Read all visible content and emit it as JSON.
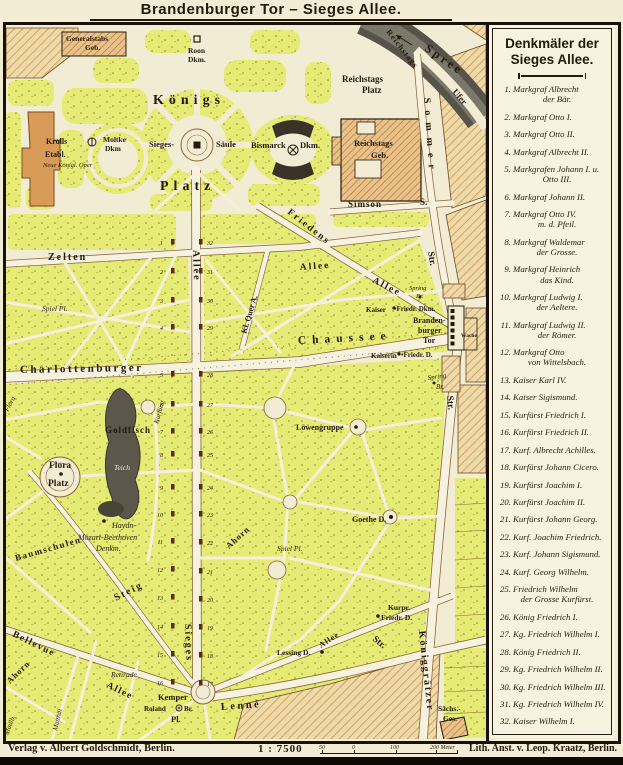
{
  "palette": {
    "paper": "#f3ecd4",
    "park": "#e5eb74",
    "built_hatch": "#eedaa8",
    "building": "#e9c28b",
    "building_solid": "#d89c58",
    "water": "#57534a",
    "road_edge": "#8a6636",
    "ink": "#241a0c",
    "monument": "#5d2a12"
  },
  "title": "Brandenburger Tor – Sieges Allee.",
  "legend": {
    "title_line1": "Denkmäler der",
    "title_line2": "Sieges Allee.",
    "entries": [
      {
        "n": "1.",
        "text": "Markgraf Albrecht",
        "line2": "der Bär."
      },
      {
        "n": "2.",
        "text": "Markgraf Otto I."
      },
      {
        "n": "3.",
        "text": "Markgraf Otto II."
      },
      {
        "n": "4.",
        "text": "Markgraf Albrecht II."
      },
      {
        "n": "5.",
        "text": "Markgrafen Johann I. u.",
        "line2": "Otto III."
      },
      {
        "n": "6.",
        "text": "Markgraf Johann II."
      },
      {
        "n": "7.",
        "text": "Markgraf Otto IV.",
        "line2": "m. d. Pfeil."
      },
      {
        "n": "8.",
        "text": "Markgraf Waldemar",
        "line2": "der Grosse."
      },
      {
        "n": "9.",
        "text": "Markgraf Heinrich",
        "line2": "das Kind."
      },
      {
        "n": "10.",
        "text": "Markgraf Ludwig I.",
        "line2": "der Aeltere."
      },
      {
        "n": "11.",
        "text": "Markgraf Ludwig II.",
        "line2": "der Römer."
      },
      {
        "n": "12.",
        "text": "Markgraf Otto",
        "line2": "von Wittelsbach."
      },
      {
        "n": "13.",
        "text": "Kaiser Karl IV."
      },
      {
        "n": "14.",
        "text": "Kaiser Sigismund."
      },
      {
        "n": "15.",
        "text": "Kurfürst Friedrich I."
      },
      {
        "n": "16.",
        "text": "Kurfürst Friedrich II."
      },
      {
        "n": "17.",
        "text": "Kurf. Albrecht Achilles."
      },
      {
        "n": "18.",
        "text": "Kurfürst Johann Cicero."
      },
      {
        "n": "19.",
        "text": "Kurfürst Joachim I."
      },
      {
        "n": "20.",
        "text": "Kurfürst Joachim II."
      },
      {
        "n": "21.",
        "text": "Kurfürst Johann Georg."
      },
      {
        "n": "22.",
        "text": "Kurf. Joachim Friedrich."
      },
      {
        "n": "23.",
        "text": "Kurf. Johann Sigismund."
      },
      {
        "n": "24.",
        "text": "Kurf. Georg Wilhelm."
      },
      {
        "n": "25.",
        "text": "Friedrich Wilhelm",
        "line2": "der Grosse Kurfürst."
      },
      {
        "n": "26.",
        "text": "König Friedrich I."
      },
      {
        "n": "27.",
        "text": "Kg. Friedrich Wilhelm I."
      },
      {
        "n": "28.",
        "text": "König Friedrich II."
      },
      {
        "n": "29.",
        "text": "Kg. Friedrich Wilhelm II."
      },
      {
        "n": "30.",
        "text": "Kg. Friedrich Wilhelm III."
      },
      {
        "n": "31.",
        "text": "Kg. Friedrich Wilhelm IV."
      },
      {
        "n": "32.",
        "text": "Kaiser Wilhelm I."
      }
    ]
  },
  "map": {
    "labels": [
      {
        "t": "Generalstabs",
        "x": 66,
        "y": 41,
        "s": 7.5
      },
      {
        "t": "Geb.",
        "x": 85,
        "y": 50,
        "s": 7.5
      },
      {
        "t": "Roon",
        "x": 188,
        "y": 53,
        "s": 7.5
      },
      {
        "t": "Dkm.",
        "x": 188,
        "y": 62,
        "s": 7.5
      },
      {
        "t": "Reichstags",
        "x": 386,
        "y": 32,
        "s": 8,
        "r": 52,
        "ls": 1
      },
      {
        "t": "Spree",
        "x": 424,
        "y": 50,
        "s": 12,
        "r": 35,
        "ls": 3
      },
      {
        "t": "Ufer",
        "x": 452,
        "y": 92,
        "s": 9,
        "r": 50
      },
      {
        "t": "Reichstags",
        "x": 342,
        "y": 82,
        "s": 9
      },
      {
        "t": "Platz",
        "x": 362,
        "y": 93,
        "s": 9
      },
      {
        "t": "Königs",
        "x": 153,
        "y": 104,
        "s": 14,
        "ls": 5
      },
      {
        "t": "Platz",
        "x": 160,
        "y": 190,
        "s": 14,
        "ls": 5
      },
      {
        "t": "Krolls",
        "x": 46,
        "y": 144,
        "s": 8
      },
      {
        "t": "Etabl.",
        "x": 45,
        "y": 157,
        "s": 8
      },
      {
        "t": "Neue Königl. Oper",
        "x": 43,
        "y": 167,
        "s": 6.5,
        "c": "i"
      },
      {
        "t": "Moltke",
        "x": 103,
        "y": 142,
        "s": 7.5
      },
      {
        "t": "Dkm",
        "x": 105,
        "y": 151,
        "s": 7.5
      },
      {
        "t": "Sieges-",
        "x": 149,
        "y": 147,
        "s": 8.5
      },
      {
        "t": "Säule",
        "x": 216,
        "y": 147,
        "s": 8.5
      },
      {
        "t": "Bismarck",
        "x": 251,
        "y": 148,
        "s": 8.5
      },
      {
        "t": "Dkm.",
        "x": 300,
        "y": 148,
        "s": 8.5
      },
      {
        "t": "Reichstags",
        "x": 354,
        "y": 146,
        "s": 8.5
      },
      {
        "t": "Geb.",
        "x": 371,
        "y": 158,
        "s": 8.5
      },
      {
        "t": "Sommer",
        "x": 424,
        "y": 98,
        "s": 10,
        "r": 86,
        "ls": 7
      },
      {
        "t": "Str.",
        "x": 428,
        "y": 252,
        "s": 9.5,
        "r": 80
      },
      {
        "t": "Simson",
        "x": 348,
        "y": 207,
        "s": 9,
        "ls": 1
      },
      {
        "t": "S.",
        "x": 420,
        "y": 205,
        "s": 9
      },
      {
        "t": "Friedens",
        "x": 287,
        "y": 213,
        "s": 9.5,
        "r": 38,
        "ls": 2
      },
      {
        "t": "Allee",
        "x": 300,
        "y": 270,
        "s": 9.5,
        "r": -4,
        "ls": 2
      },
      {
        "t": "Allee",
        "x": 372,
        "y": 282,
        "s": 9.5,
        "r": 27,
        "ls": 2
      },
      {
        "t": "Zelten",
        "x": 48,
        "y": 260,
        "s": 10,
        "ls": 2
      },
      {
        "t": "Allee",
        "x": 193,
        "y": 250,
        "s": 10,
        "r": 88,
        "ls": 2
      },
      {
        "t": "Kl. Quer A.",
        "x": 246,
        "y": 334,
        "s": 8,
        "r": -73
      },
      {
        "t": "Spiel Pl.",
        "x": 42,
        "y": 311,
        "s": 7.5,
        "c": "i"
      },
      {
        "t": "Charlottenburger",
        "x": 20,
        "y": 373,
        "s": 11,
        "ls": 2.5,
        "r": -1
      },
      {
        "t": "Chaussee",
        "x": 298,
        "y": 344,
        "s": 11.5,
        "r": -3,
        "ls": 6
      },
      {
        "t": "Kaiser",
        "x": 366,
        "y": 312,
        "s": 7
      },
      {
        "t": "•Friedr. Dkm.",
        "x": 394,
        "y": 311,
        "s": 7
      },
      {
        "t": "Branden-",
        "x": 413,
        "y": 323,
        "s": 8
      },
      {
        "t": "burger",
        "x": 418,
        "y": 333,
        "s": 8
      },
      {
        "t": "Tor",
        "x": 423,
        "y": 343,
        "s": 8
      },
      {
        "t": "Wache",
        "x": 461,
        "y": 337,
        "s": 5.5
      },
      {
        "t": "Kaiserin",
        "x": 371,
        "y": 358,
        "s": 7
      },
      {
        "t": "•Friedr. D.",
        "x": 401,
        "y": 357,
        "s": 7
      },
      {
        "t": "Spring",
        "x": 409,
        "y": 290,
        "s": 6.5,
        "c": "i"
      },
      {
        "t": "Br.",
        "x": 416,
        "y": 298,
        "s": 6.5,
        "c": "i"
      },
      {
        "t": "Spring",
        "x": 428,
        "y": 380,
        "s": 7,
        "r": -8,
        "c": "i"
      },
      {
        "t": "Br.",
        "x": 436,
        "y": 389,
        "s": 7,
        "c": "i"
      },
      {
        "t": "Str.",
        "x": 447,
        "y": 396,
        "s": 9.5,
        "r": 84
      },
      {
        "t": "Steig",
        "x": 116,
        "y": 601,
        "s": 10,
        "r": -27,
        "ls": 2
      },
      {
        "t": "Flora",
        "x": 49,
        "y": 468,
        "s": 9.5
      },
      {
        "t": "Platz",
        "x": 48,
        "y": 486,
        "s": 9.5
      },
      {
        "t": "Goldfisch",
        "x": 105,
        "y": 433,
        "s": 9,
        "ls": 1
      },
      {
        "t": "Teich",
        "x": 114,
        "y": 470,
        "s": 7.5,
        "c": "ip"
      },
      {
        "t": "Kurfürst",
        "x": 158,
        "y": 424,
        "s": 7,
        "r": -74,
        "c": "i"
      },
      {
        "t": "Löwengruppe",
        "x": 296,
        "y": 430,
        "s": 8
      },
      {
        "t": "Goethe D.",
        "x": 352,
        "y": 522,
        "s": 8
      },
      {
        "t": "Spiel Pl.",
        "x": 277,
        "y": 551,
        "s": 7.5,
        "c": "i"
      },
      {
        "t": "Ahorn",
        "x": 229,
        "y": 549,
        "s": 8.5,
        "r": -42,
        "ls": 1
      },
      {
        "t": "Haydn-",
        "x": 112,
        "y": 528,
        "s": 8,
        "c": "i"
      },
      {
        "t": "Mozart-Beethoven",
        "x": 78,
        "y": 540,
        "s": 8,
        "c": "i"
      },
      {
        "t": "Denkm.",
        "x": 96,
        "y": 551,
        "s": 8,
        "c": "i"
      },
      {
        "t": "Baumschulen",
        "x": 16,
        "y": 561,
        "s": 9,
        "r": -16,
        "ls": 1.5
      },
      {
        "t": "Flora",
        "x": 8,
        "y": 412,
        "s": 7,
        "r": -62,
        "c": "i"
      },
      {
        "t": "Bellevue",
        "x": 12,
        "y": 636,
        "s": 9.5,
        "r": 26,
        "ls": 1.5
      },
      {
        "t": "Allee",
        "x": 106,
        "y": 687,
        "s": 9.5,
        "r": 26,
        "ls": 1.5
      },
      {
        "t": "Ahorn",
        "x": 10,
        "y": 684,
        "s": 8.5,
        "r": -44,
        "ls": 1
      },
      {
        "t": "Retirade",
        "x": 111,
        "y": 677,
        "s": 7.5,
        "c": "i"
      },
      {
        "t": "Kemper",
        "x": 158,
        "y": 700,
        "s": 8.5
      },
      {
        "t": "Roland",
        "x": 144,
        "y": 711,
        "s": 7
      },
      {
        "t": "Br.",
        "x": 184,
        "y": 711,
        "s": 7
      },
      {
        "t": "Pl.",
        "x": 171,
        "y": 722,
        "s": 8.5
      },
      {
        "t": "Lenné",
        "x": 221,
        "y": 710,
        "s": 10.5,
        "r": -4,
        "ls": 2.5
      },
      {
        "t": "Lessing D.",
        "x": 277,
        "y": 655,
        "s": 7.5
      },
      {
        "t": "Allee",
        "x": 321,
        "y": 648,
        "s": 8,
        "r": -33,
        "ls": 1
      },
      {
        "t": "Sieges",
        "x": 185,
        "y": 624,
        "s": 10,
        "r": 88,
        "ls": 2
      },
      {
        "t": "Kurpr.",
        "x": 388,
        "y": 610,
        "s": 7.5
      },
      {
        "t": "Friedr. D.",
        "x": 381,
        "y": 620,
        "s": 7.5
      },
      {
        "t": "Str.",
        "x": 372,
        "y": 640,
        "s": 9.5,
        "r": 38
      },
      {
        "t": "Königgrätzer",
        "x": 419,
        "y": 631,
        "s": 10,
        "r": 84,
        "ls": 2
      },
      {
        "t": "Sächs.-",
        "x": 438,
        "y": 711,
        "s": 7.5
      },
      {
        "t": "Ges.",
        "x": 443,
        "y": 721,
        "s": 7.5
      },
      {
        "t": "Matthäi",
        "x": 57,
        "y": 731,
        "s": 7,
        "r": -77,
        "c": "i"
      },
      {
        "t": "Maulb.",
        "x": 8,
        "y": 735,
        "s": 7,
        "r": -68,
        "c": "i"
      }
    ],
    "monuments": {
      "west_x": 163,
      "east_x": 207,
      "marker_west_x": 171,
      "marker_east_x": 199,
      "west": [
        {
          "n": "1",
          "y": 243
        },
        {
          "n": "2",
          "y": 272
        },
        {
          "n": "3",
          "y": 301
        },
        {
          "n": "4",
          "y": 328
        },
        {
          "n": "5",
          "y": 375
        },
        {
          "n": "6",
          "y": 405
        },
        {
          "n": "7",
          "y": 432
        },
        {
          "n": "8",
          "y": 455
        },
        {
          "n": "9",
          "y": 488
        },
        {
          "n": "10",
          "y": 515
        },
        {
          "n": "11",
          "y": 542
        },
        {
          "n": "12",
          "y": 570
        },
        {
          "n": "13",
          "y": 598
        },
        {
          "n": "14",
          "y": 627
        },
        {
          "n": "15",
          "y": 655
        },
        {
          "n": "16",
          "y": 683
        }
      ],
      "east": [
        {
          "n": "32",
          "y": 243
        },
        {
          "n": "31",
          "y": 272
        },
        {
          "n": "30",
          "y": 301
        },
        {
          "n": "29",
          "y": 328
        },
        {
          "n": "28",
          "y": 375
        },
        {
          "n": "27",
          "y": 405
        },
        {
          "n": "26",
          "y": 432
        },
        {
          "n": "25",
          "y": 455
        },
        {
          "n": "24",
          "y": 488
        },
        {
          "n": "23",
          "y": 515
        },
        {
          "n": "22",
          "y": 543
        },
        {
          "n": "21",
          "y": 572
        },
        {
          "n": "20",
          "y": 600
        },
        {
          "n": "19",
          "y": 628
        },
        {
          "n": "18",
          "y": 656
        },
        {
          "n": "17",
          "y": 684
        }
      ]
    }
  },
  "footer": {
    "publisher": "Verlag v. Albert Goldschmidt, Berlin.",
    "scale": "1 : 7500",
    "scale_ticks": [
      "50",
      "0",
      "100",
      "200 Meter"
    ],
    "lith": "Lith. Anst. v. Leop. Kraatz, Berlin."
  }
}
